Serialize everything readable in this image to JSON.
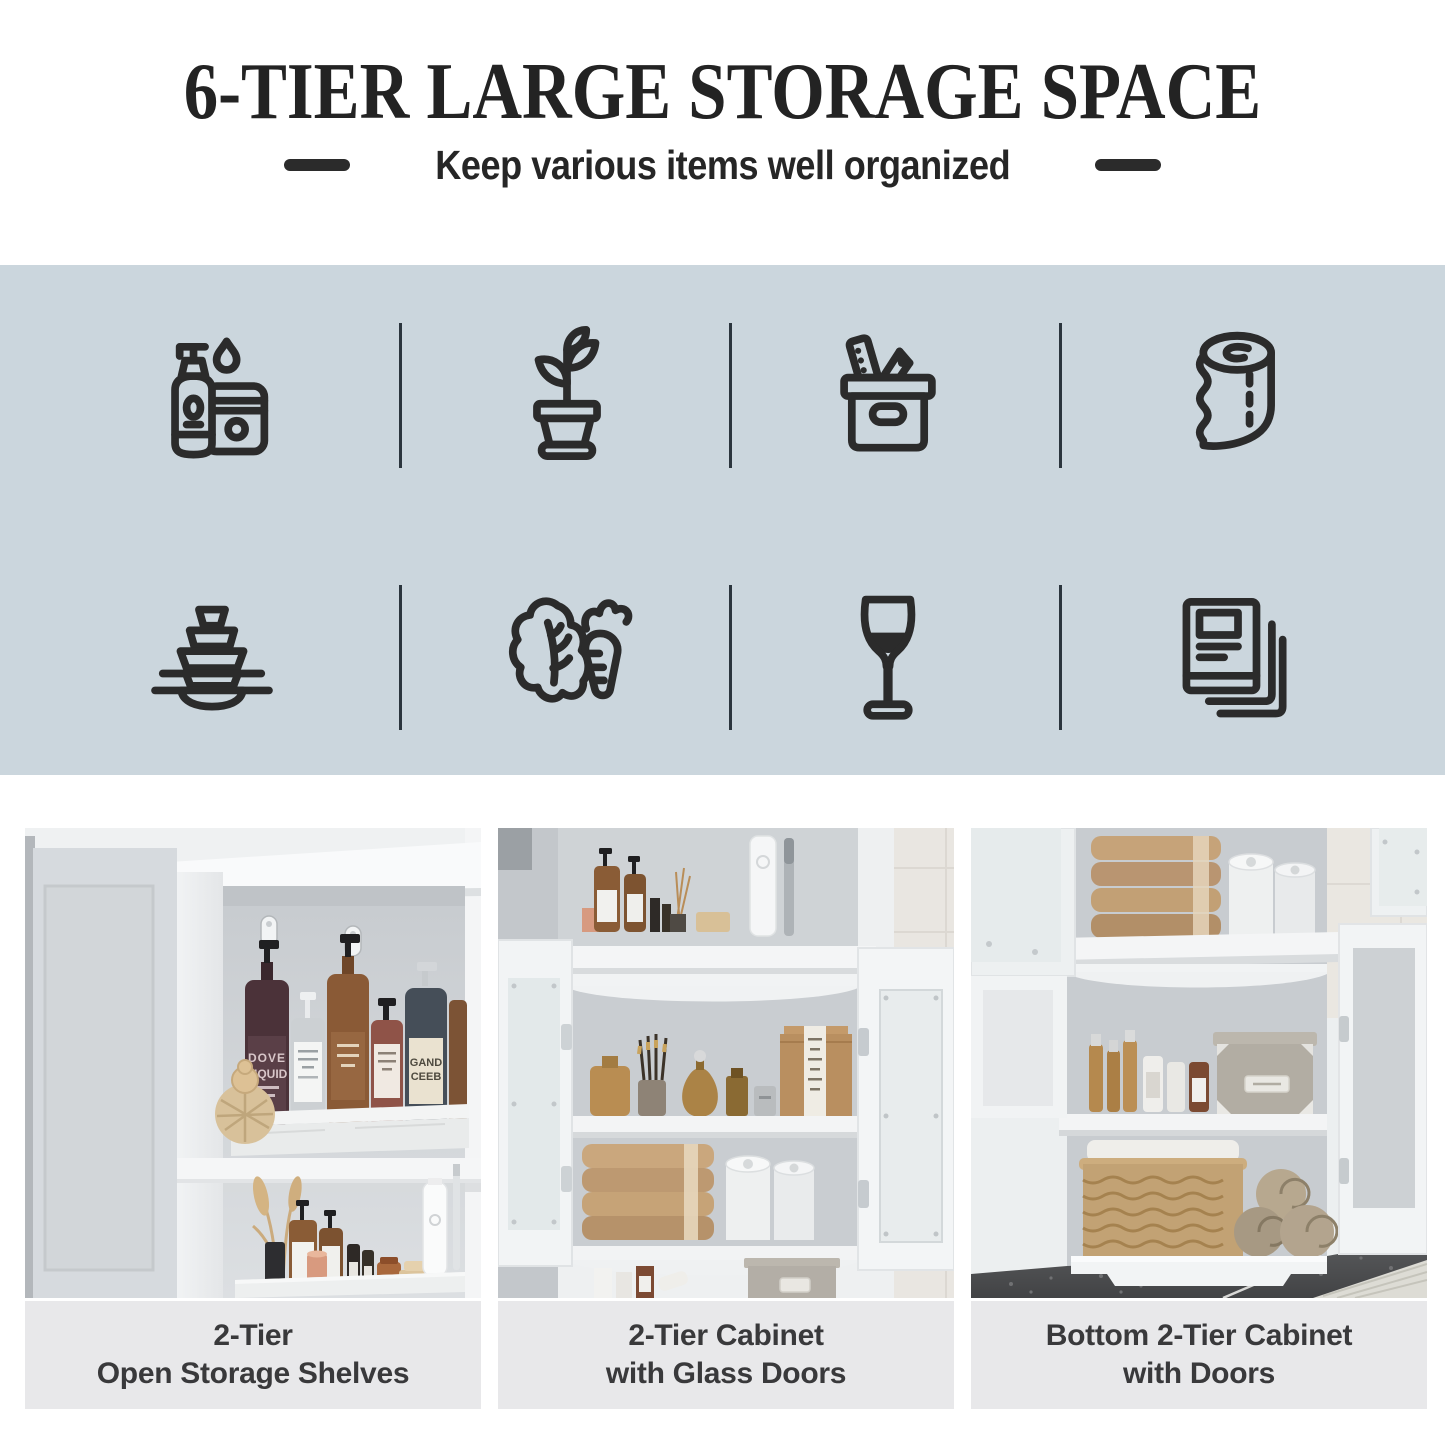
{
  "header": {
    "title": "6-TIER LARGE STORAGE SPACE",
    "subtitle": "Keep various items well organized"
  },
  "colors": {
    "feature_band_bg": "#cbd6dd",
    "icon_ink": "#2b2b2b",
    "divider_ink": "#2b353d",
    "caption_bg": "#e8e8ea",
    "caption_ink": "#39393b",
    "title_ink": "#232323"
  },
  "features": {
    "icons": [
      {
        "name": "toiletries-icon",
        "label": "Lotion pump bottle and jar"
      },
      {
        "name": "potted-plant-icon",
        "label": "Potted plant"
      },
      {
        "name": "storage-box-icon",
        "label": "Storage box with items"
      },
      {
        "name": "toilet-paper-icon",
        "label": "Toilet paper roll"
      },
      {
        "name": "dishes-icon",
        "label": "Stacked bowls and plates"
      },
      {
        "name": "vegetables-icon",
        "label": "Lettuce and carrot"
      },
      {
        "name": "wine-glass-icon",
        "label": "Wine glass"
      },
      {
        "name": "books-icon",
        "label": "Books and documents"
      }
    ]
  },
  "gallery": {
    "items": [
      {
        "caption_lines": [
          "2-Tier",
          "Open Storage Shelves"
        ],
        "alt": "White cabinet with two open storage shelves holding soap pump bottles on a marble tray, a wooden brush, dried grass, candles, a cream tube and an electric toothbrush",
        "photo_text": [
          "DOVE",
          "LIQUID",
          "GAND",
          "CEEB"
        ]
      },
      {
        "caption_lines": [
          "2-Tier Cabinet",
          "with Glass Doors"
        ],
        "alt": "Two-tier cabinet with frosted glass doors open showing perfumes, makeup brushes, a kraft box, folded tan towels, toilet paper rolls and a gray storage box"
      },
      {
        "caption_lines": [
          "Bottom 2-Tier Cabinet",
          "with Doors"
        ],
        "alt": "Bottom two-tier cabinet with doors open showing gold cosmetic bottles, a gray fabric box, a wicker basket and rolled towels above a dark stone floor"
      }
    ]
  }
}
